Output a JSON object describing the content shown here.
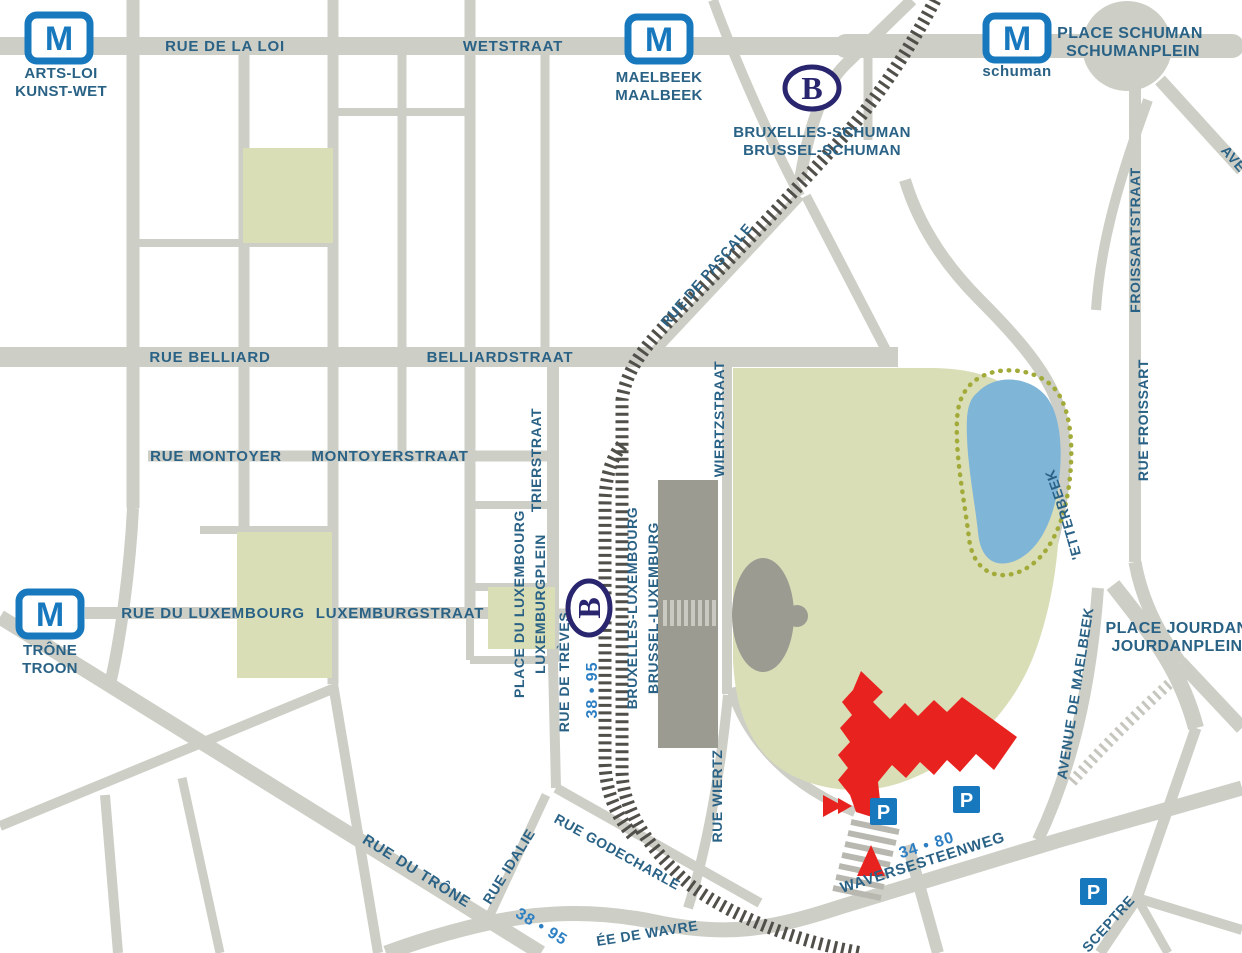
{
  "map_type": "street-map-brussels-european-quarter",
  "colors": {
    "background": "#ffffff",
    "road": "#cdcec6",
    "street_label": "#2a6286",
    "bus_label": "#2d7fc3",
    "metro_blue": "#1878be",
    "rail_navy": "#29256e",
    "parking_blue": "#1878be",
    "park_green": "#dadeb7",
    "pond_blue": "#7fb5d7",
    "dotted_path": "#a2ab3a",
    "building_gray": "#9b9b92",
    "parliament_red": "#e8231f",
    "railway_dark": "#504f49",
    "railway_light": "#c6c6bf"
  },
  "stations": {
    "logo_letter_metro": "M",
    "logo_letter_rail": "B",
    "parking_letter": "P",
    "metro": [
      {
        "name_fr": "ARTS-LOI",
        "name_nl": "KUNST-WET"
      },
      {
        "name_fr": "MAELBEEK",
        "name_nl": "MAALBEEK"
      },
      {
        "name": "schuman"
      },
      {
        "name_fr": "TRÔNE",
        "name_nl": "TROON"
      }
    ],
    "rail": [
      {
        "name_fr": "BRUXELLES-SCHUMAN",
        "name_nl": "BRUSSEL-SCHUMAN"
      },
      {
        "name_fr": "BRUXELLES-LUXEMBOURG",
        "name_nl": "BRUSSEL-LUXEMBURG"
      }
    ]
  },
  "places": {
    "schuman_fr": "PLACE SCHUMAN",
    "schuman_nl": "SCHUMANPLEIN",
    "jourdan_fr": "PLACE JOURDAN",
    "jourdan_nl": "JOURDANPLEIN",
    "luxembourg_fr": "PLACE DU LUXEMBOURG",
    "luxembourg_nl": "LUXEMBURGPLEIN"
  },
  "streets": {
    "rue_de_la_loi": "RUE DE LA LOI",
    "wetstraat": "WETSTRAAT",
    "rue_belliard": "RUE BELLIARD",
    "belliardstraat": "BELLIARDSTRAAT",
    "rue_montoyer": "RUE MONTOYER",
    "montoyerstraat": "MONTOYERSTRAAT",
    "rue_du_luxembourg": "RUE DU LUXEMBOURG",
    "luxemburgstraat": "LUXEMBURGSTRAAT",
    "trierstraat": "TRIERSTRAAT",
    "rue_de_treves": "RUE DE TRÈVES",
    "rue_de_pascale": "RUE DE PASCALE",
    "wiertzstraat": "WIERTZSTRAAT",
    "rue_wiertz": "RUE WIERTZ",
    "froissartstraat": "FROISSARTSTRAAT",
    "rue_froissart": "RUE FROISSART",
    "chaussee_etterbeek": "CHAUSSÉE D'ETTERBEEK",
    "avenue_de_maelbeek": "AVENUE DE MAELBEEK",
    "rue_godecharle": "RUE GODECHARLE",
    "rue_idalie": "RUE IDALIE",
    "rue_du_trone": "RUE DU TRÔNE",
    "waversesteenweg": "WAVERSESTEENWEG",
    "chaussee_de_wavre_partial": "ÉE DE WAVRE",
    "sceptre_partial": "SCEPTRE",
    "avenue_partial": "AVE"
  },
  "bus_routes": {
    "r38_95": "38 • 95",
    "r34_80": "34 • 80"
  }
}
